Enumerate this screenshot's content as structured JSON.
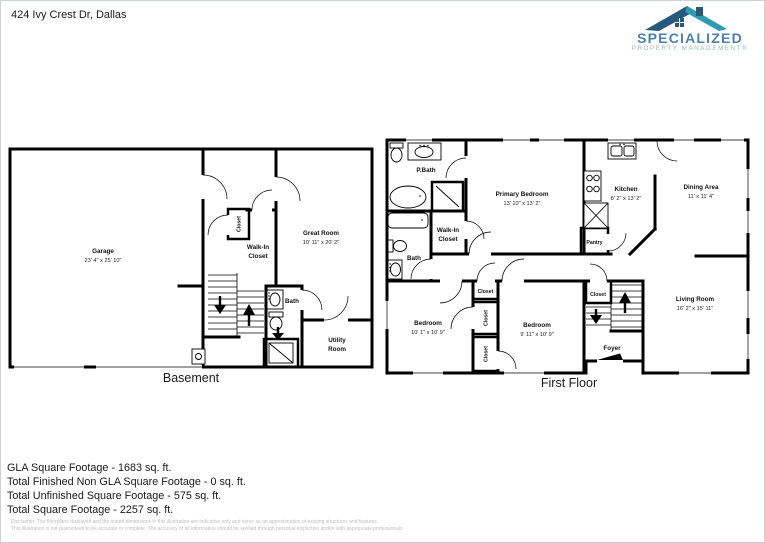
{
  "page": {
    "address": "424 Ivy Crest Dr, Dallas"
  },
  "logo": {
    "brand": "SPECIALIZED",
    "tagline": "PROPERTY MANAGEMENT®"
  },
  "colors": {
    "brand_blue": "#4d80ae",
    "tagline_blue": "#9db4c9",
    "roof_dark": "#27597f",
    "roof_teal": "#2d9cb3",
    "wall_black": "#000000",
    "disclaimer_gray": "#bdbdbd"
  },
  "basement": {
    "caption": "Basement",
    "garage_name": "Garage",
    "garage_dims": "23' 4\" x 25' 10\"",
    "great_room_name": "Great Room",
    "great_room_dims": "10' 11\" x 20' 2\"",
    "closet": "Closet",
    "walk_in_line1": "Walk-In",
    "walk_in_line2": "Closet",
    "bath": "Bath",
    "utility_line1": "Utility",
    "utility_line2": "Room"
  },
  "first_floor": {
    "caption": "First Floor",
    "pbath": "P.Bath",
    "primary_name": "Primary Bedroom",
    "primary_dims": "13' 10\" x 13' 2\"",
    "kitchen_name": "Kitchen",
    "kitchen_dims": "8' 2\" x 13' 2\"",
    "dining_name": "Dining Area",
    "dining_dims": "11' x 11' 4\"",
    "walk_in_line1": "Walk-In",
    "walk_in_line2": "Closet",
    "bath": "Bath",
    "pantry": "Pantry",
    "bedroom_left_name": "Bedroom",
    "bedroom_left_dims": "10' 1\" x 10' 9\"",
    "bedroom_mid_name": "Bedroom",
    "bedroom_mid_dims": "9' 11\" x 10' 9\"",
    "living_name": "Living Room",
    "living_dims": "16' 2\" x 15' 11\"",
    "foyer": "Foyer",
    "closet_hall_top": "Closet",
    "closet_mid": "Closet",
    "closet_bottom": "Closet",
    "closet_stairs": "Closet"
  },
  "summary": {
    "line1": "GLA Square Footage - 1683 sq. ft.",
    "line2": "Total Finished Non GLA Square Footage - 0 sq. ft.",
    "line3": "Total Unfinished Square Footage - 575 sq. ft.",
    "line4": "Total Square Footage - 2257 sq. ft."
  },
  "disclaimer": {
    "line1": "Disclaimer: The floorplans displayed and the stated dimensions in this illustration are indicative only and serve as an approximation of existing structures and features.",
    "line2": "This illustration is not guaranteed to be accurate or complete. The accuracy of all information should be verified through personal inspection and/or with appropriate professionals."
  }
}
